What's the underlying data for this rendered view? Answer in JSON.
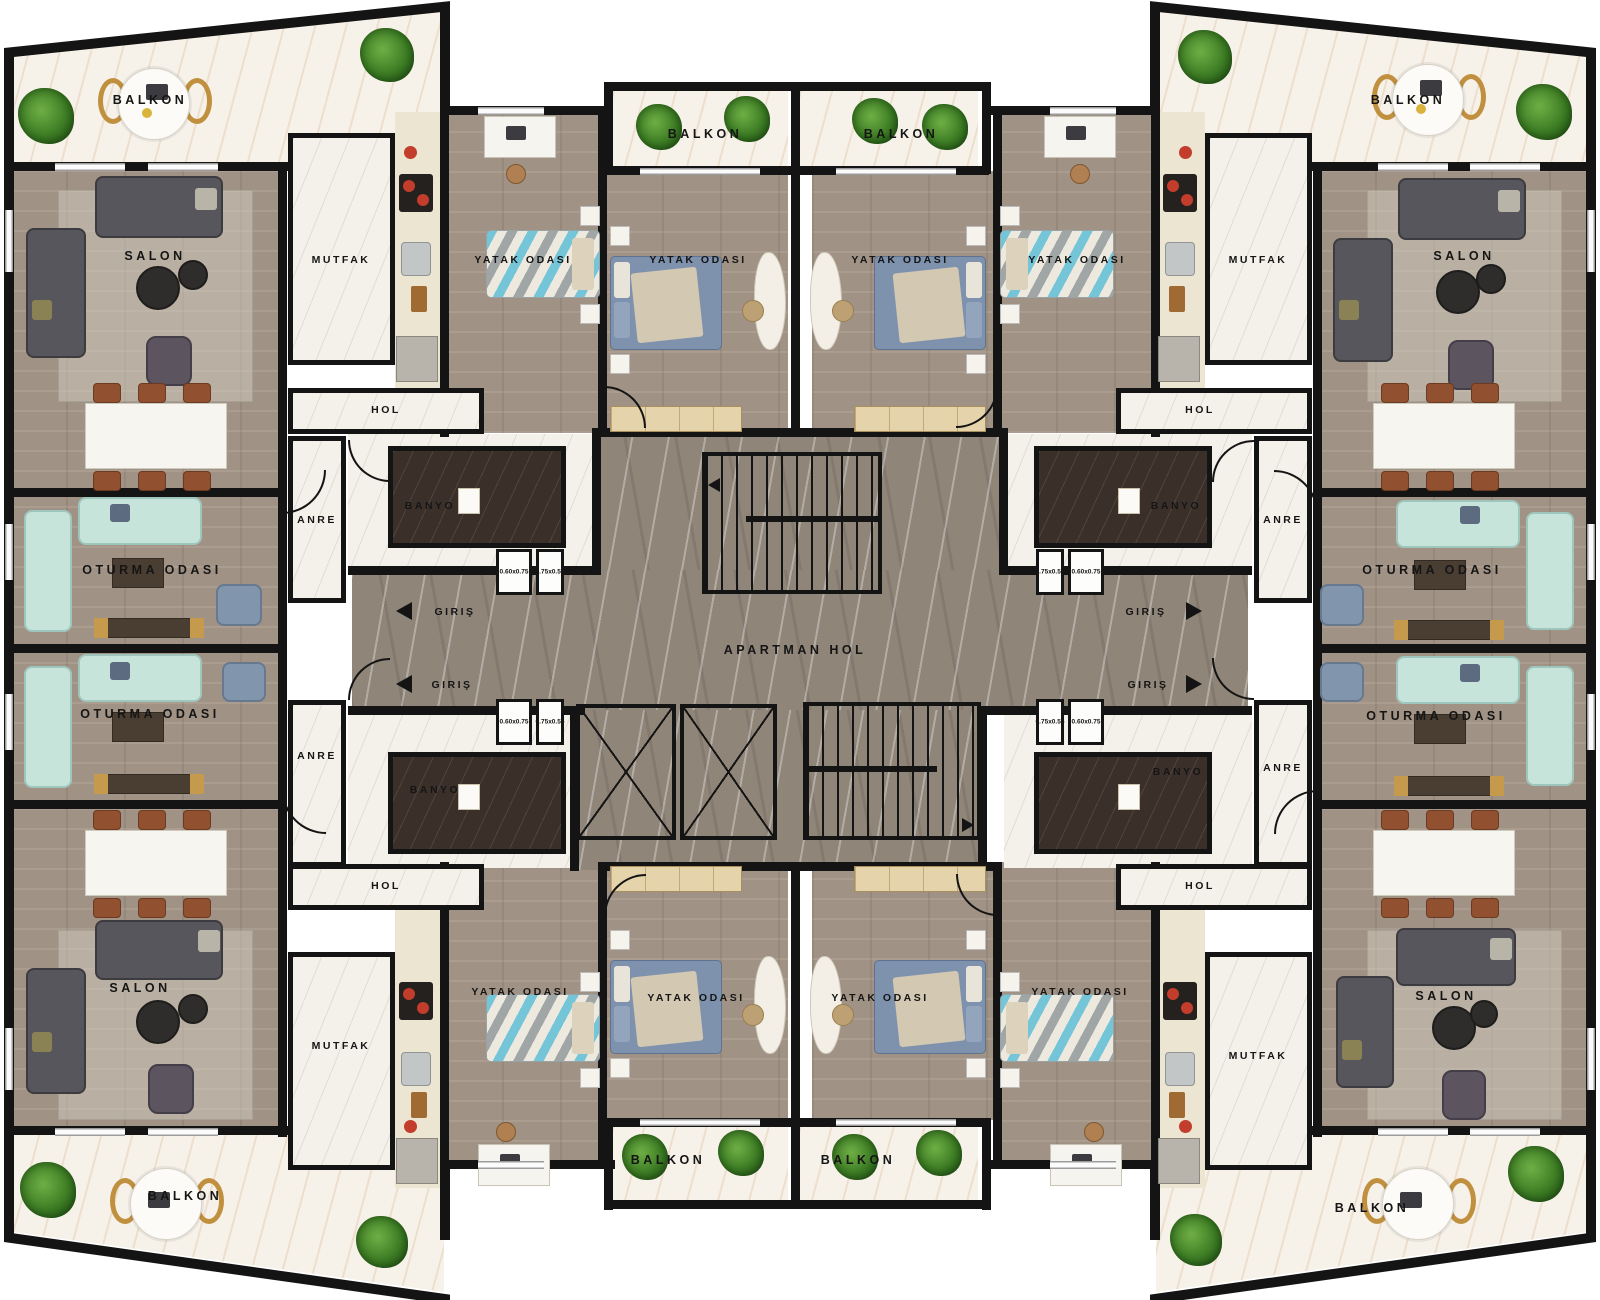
{
  "labels": {
    "balkon": "BALKON",
    "salon": "SALON",
    "mutfak": "MUTFAK",
    "hol": "HOL",
    "yatak_odasi": "YATAK ODASI",
    "oturma_odasi": "OTURMA ODASI",
    "banyo": "BANYO",
    "anre": "ANRE",
    "giris": "GIRIŞ",
    "apartman_hol": "APARTMAN HOL",
    "washer_dim": "0.60x0.75",
    "dryer_dim": "0.75x0.55"
  },
  "room_instances": [
    {
      "room": "BALKON",
      "locations": [
        "top-left-corner",
        "top-center-left",
        "top-center-right",
        "top-right-corner",
        "bottom-left-corner",
        "bottom-center-left",
        "bottom-center-right",
        "bottom-right-corner"
      ]
    },
    {
      "room": "SALON",
      "locations": [
        "top-left",
        "top-right",
        "bottom-left",
        "bottom-right"
      ]
    },
    {
      "room": "MUTFAK",
      "locations": [
        "top-left",
        "top-right",
        "bottom-left",
        "bottom-right"
      ]
    },
    {
      "room": "HOL",
      "locations": [
        "top-left",
        "top-right",
        "bottom-left",
        "bottom-right"
      ]
    },
    {
      "room": "YATAK ODASI",
      "locations": [
        "top-left-small",
        "top-left-large",
        "top-right-large",
        "top-right-small",
        "bottom-left-small",
        "bottom-left-large",
        "bottom-right-large",
        "bottom-right-small"
      ]
    },
    {
      "room": "OTURMA ODASI",
      "locations": [
        "left-upper",
        "left-lower",
        "right-upper",
        "right-lower"
      ]
    },
    {
      "room": "BANYO",
      "locations": [
        "left-upper",
        "left-lower",
        "right-upper",
        "right-lower"
      ]
    },
    {
      "room": "ANRE",
      "locations": [
        "left-upper",
        "left-lower",
        "right-upper",
        "right-lower"
      ]
    },
    {
      "room": "GIRIŞ",
      "locations": [
        "left-upper",
        "left-lower",
        "right-upper",
        "right-lower"
      ]
    },
    {
      "room": "APARTMAN HOL",
      "locations": [
        "center"
      ]
    }
  ],
  "appliance_dimensions": [
    "0.60x0.75",
    "0.75x0.55"
  ],
  "features": [
    "staircase-upper",
    "staircase-lower",
    "elevator-shaft-1",
    "elevator-shaft-2"
  ],
  "colors": {
    "wall": "#141414",
    "wood_floor": "#a69889",
    "marble_light": "#f4f1ea",
    "marble_hall": "#8f8579",
    "bath_dark": "#3a3029",
    "mint_sofa": "#c7e4db",
    "dark_sofa": "#56565c",
    "bed_blue": "#7e92ad",
    "plant_green": "#3d7d24",
    "chair_brown": "#91502f",
    "gold_accent": "#c0903f"
  }
}
